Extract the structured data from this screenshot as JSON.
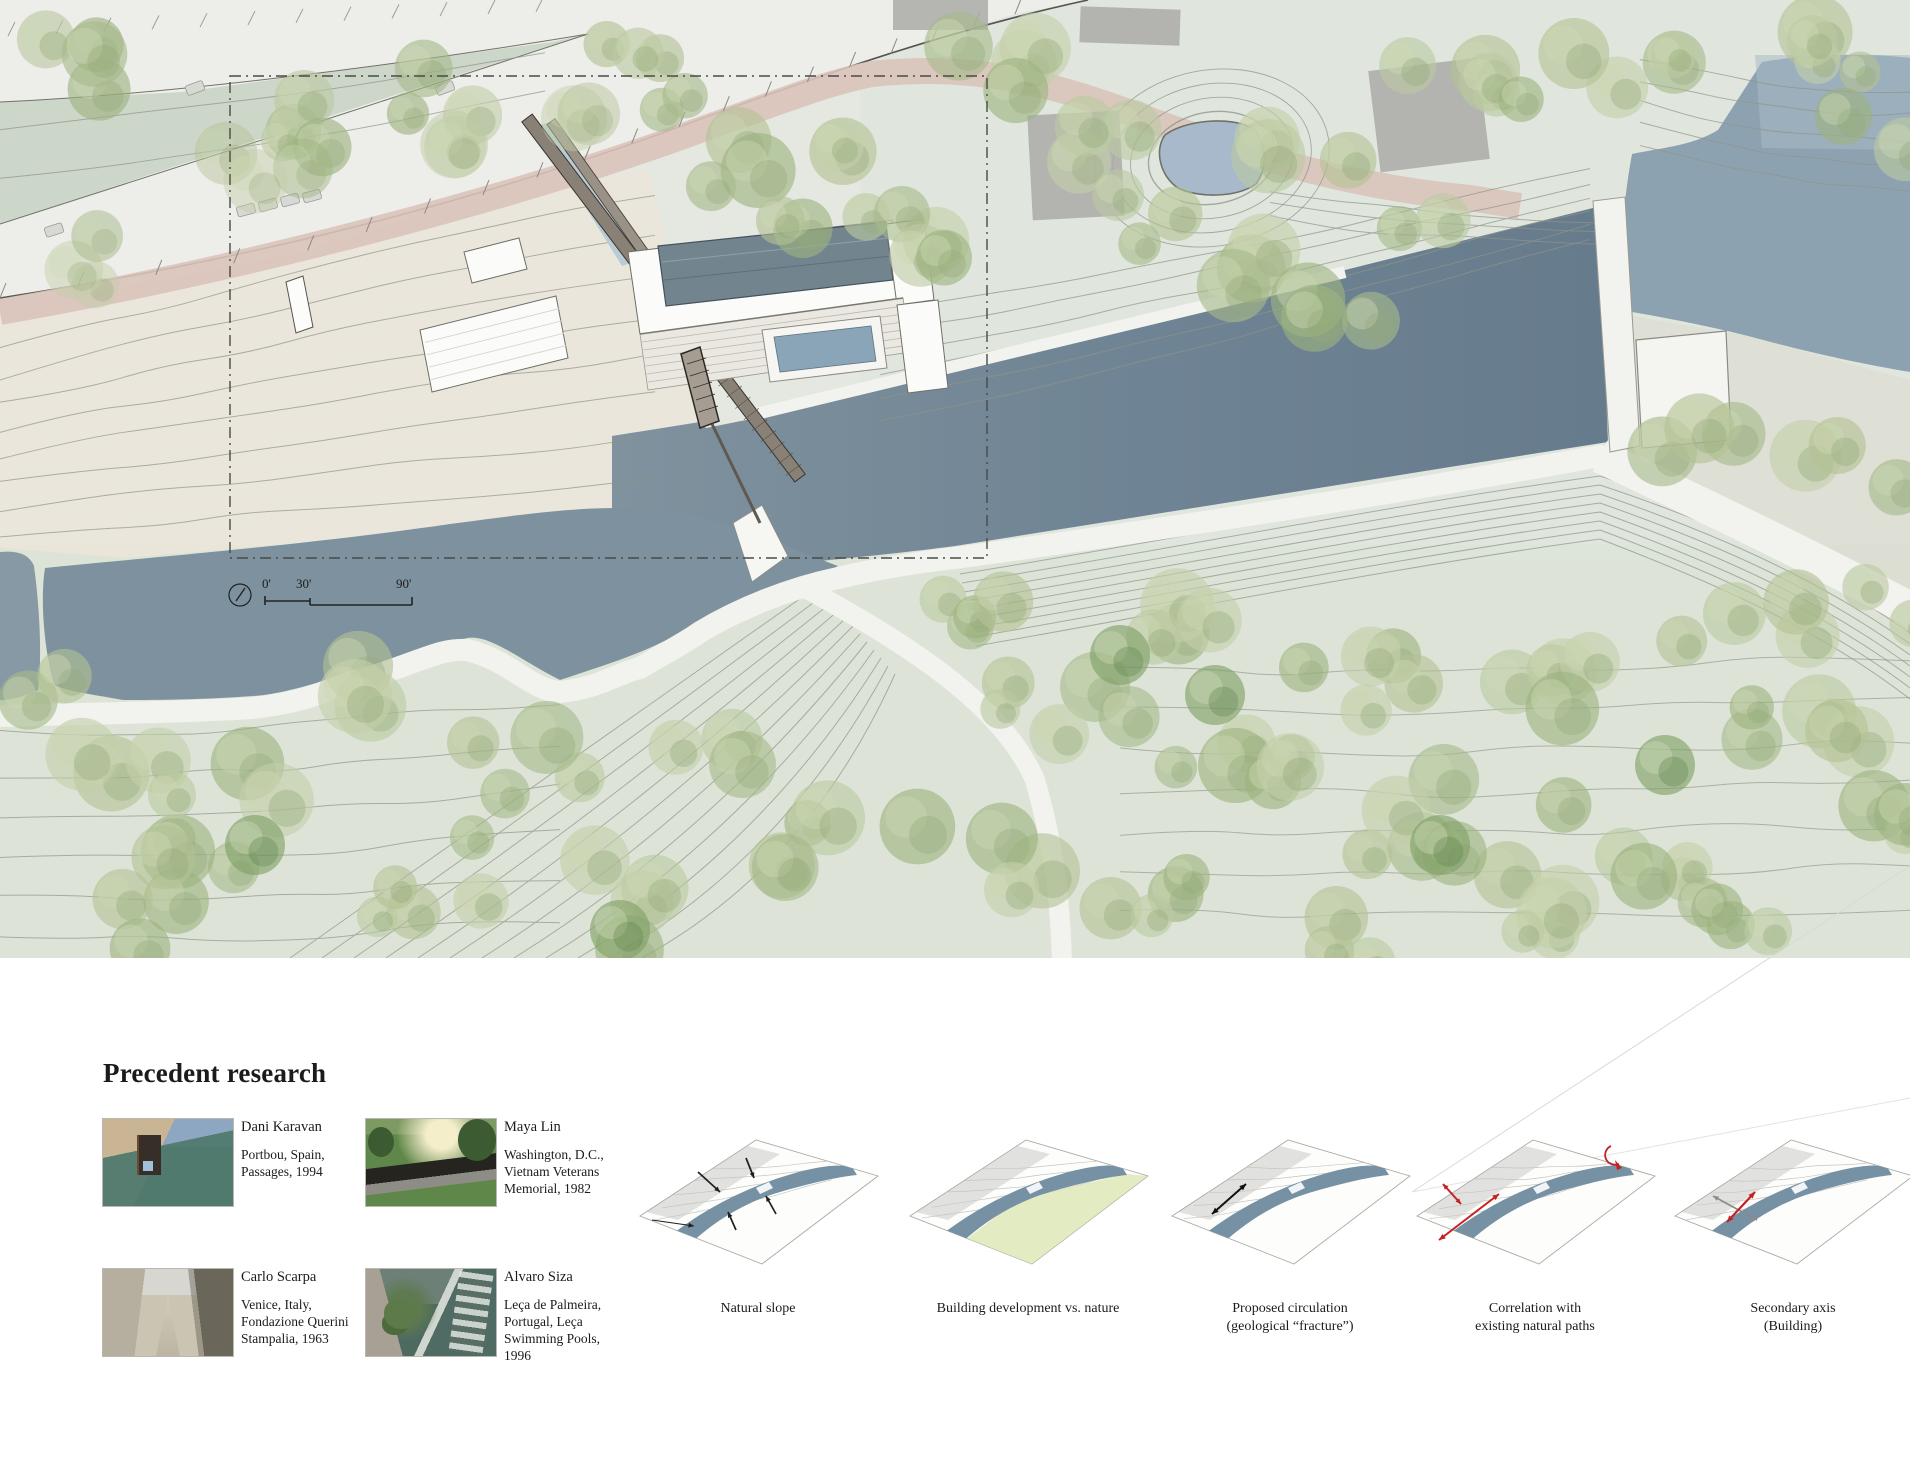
{
  "map": {
    "scale_bar": {
      "zero": "0'",
      "thirty": "30'",
      "ninety": "90'"
    }
  },
  "precedents": {
    "title": "Precedent research",
    "items": [
      {
        "name": "Dani Karavan",
        "location": [
          "Portbou, Spain,",
          "Passages, 1994"
        ],
        "photo": "karavan"
      },
      {
        "name": "Maya Lin",
        "location": [
          "Washington, D.C.,",
          "Vietnam Veterans",
          "Memorial, 1982"
        ],
        "photo": "lin"
      },
      {
        "name": "Carlo Scarpa",
        "location": [
          "Venice, Italy,",
          "Fondazione Querini",
          "Stampalia, 1963"
        ],
        "photo": "scarpa"
      },
      {
        "name": "Alvaro Siza",
        "location": [
          "Leça de Palmeira,",
          "Portugal, Leça",
          "Swimming Pools,",
          "1996"
        ],
        "photo": "siza"
      }
    ]
  },
  "diagrams": [
    {
      "type": "natural-slope",
      "label": [
        "Natural slope"
      ]
    },
    {
      "type": "development-vs-nature",
      "label": [
        "Building development vs. nature"
      ]
    },
    {
      "type": "proposed-circulation",
      "label": [
        "Proposed circulation",
        "(geological “fracture”)"
      ]
    },
    {
      "type": "natural-paths-correlation",
      "label": [
        "Correlation with",
        "existing natural paths"
      ]
    },
    {
      "type": "secondary-axis",
      "label": [
        "Secondary axis",
        "(Building)"
      ]
    }
  ],
  "colors": {
    "river": "#6f8494",
    "river_light": "#8da2b1",
    "pond": "#a7b9cb",
    "channel_water": "#b9cbd5",
    "accent_red": "#c32222",
    "nature_green": "#dde8b6",
    "path_pink": "#d9c3ba",
    "tree_green": "#a9bc8d"
  }
}
